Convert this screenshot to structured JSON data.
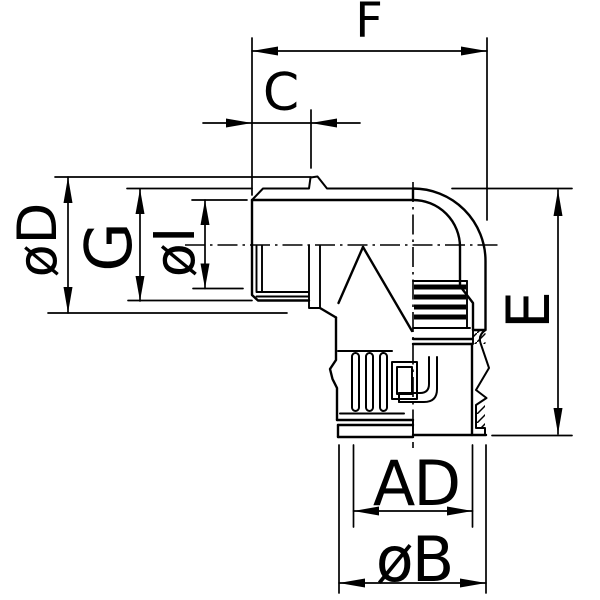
{
  "drawing": {
    "background_color": "#ffffff",
    "line_color": "#000000",
    "subject": "90-degree elbow conduit fitting, sectional technical drawing",
    "dimensions": {
      "F": "F",
      "C": "C",
      "oD": "øD",
      "G": "G",
      "oI": "øI",
      "E": "E",
      "AD": "AD",
      "oB": "øB"
    }
  }
}
